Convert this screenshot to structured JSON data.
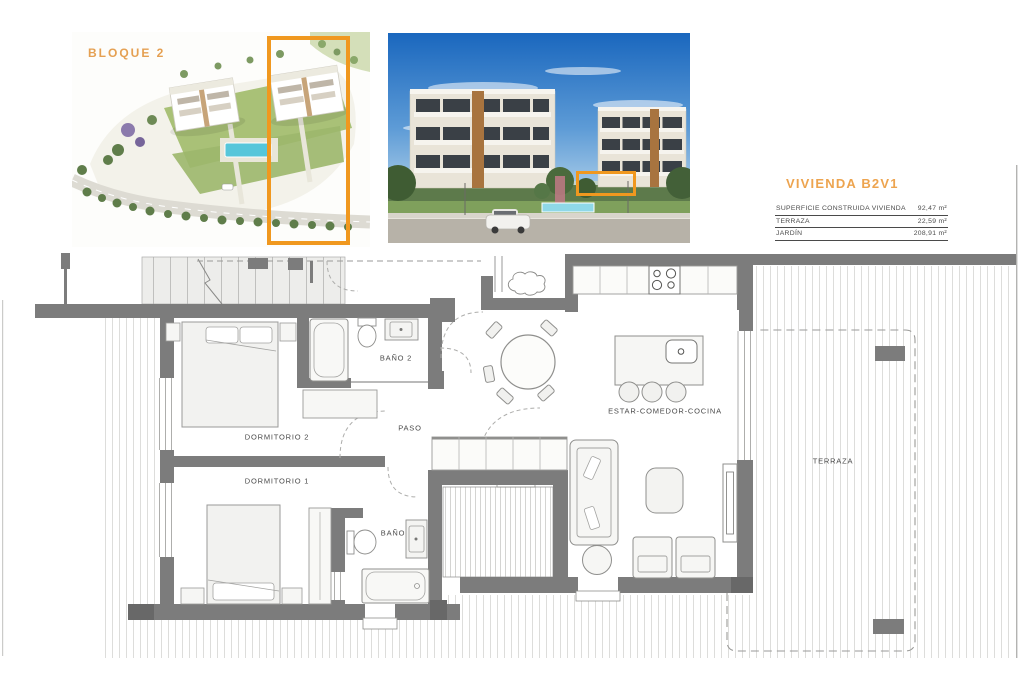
{
  "header": {
    "bloque_label": "BLOQUE 2",
    "unit_title": "VIVIENDA B2V1",
    "area_table": {
      "rows": [
        {
          "label": "SUPERFICIE CONSTRUIDA VIVIENDA",
          "value": "92,47 m²"
        },
        {
          "label": "TERRAZA",
          "value": "22,59 m²"
        },
        {
          "label": "JARDÍN",
          "value": "208,91 m²"
        }
      ]
    }
  },
  "floor_plan": {
    "room_labels": {
      "dormitorio_2": "DORMITORIO 2",
      "dormitorio_1": "DORMITORIO 1",
      "bano_2": "BAÑO 2",
      "bano": "BAÑO",
      "paso": "PASO",
      "estar": "ESTAR-COMEDOR-COCINA",
      "terraza": "TERRAZA"
    }
  },
  "colors": {
    "highlight_orange": "#F0981F",
    "title_orange": "#EDA44F",
    "wall_gray": "#7C7C7C"
  }
}
